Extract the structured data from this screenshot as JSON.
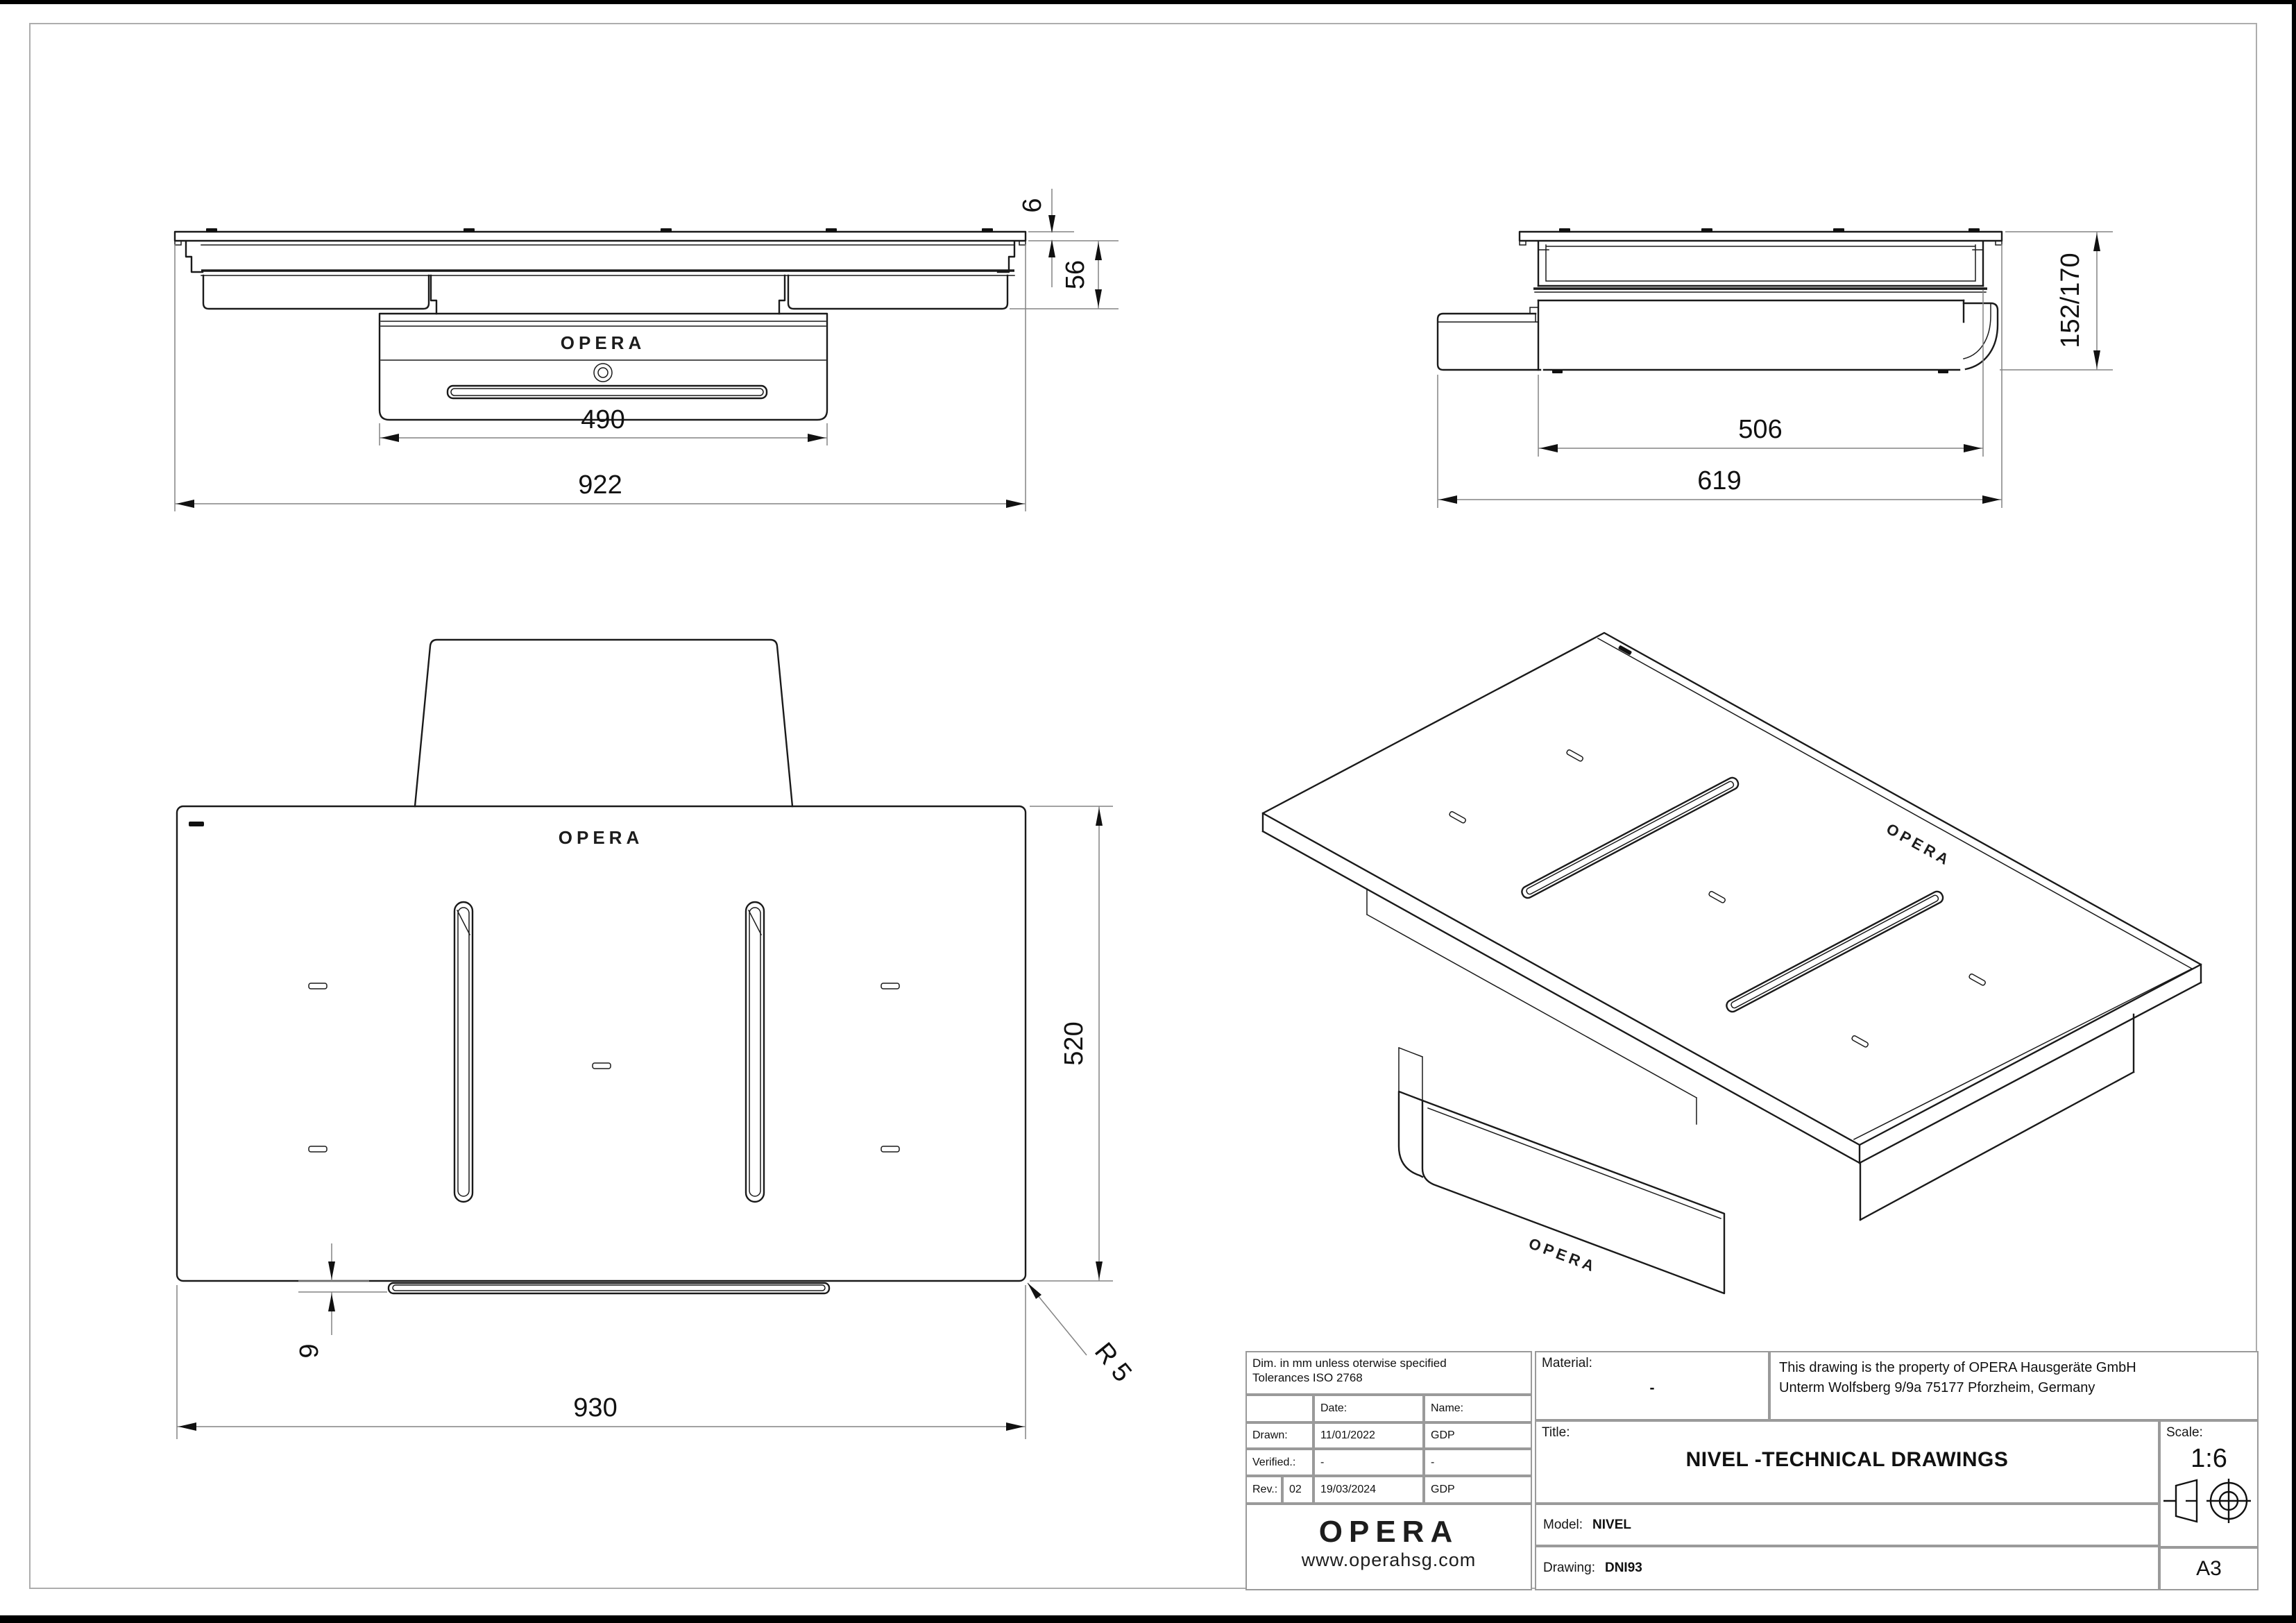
{
  "brand": {
    "name": "OPERA",
    "website": "www.operahsg.com"
  },
  "views": {
    "front": {
      "dims": {
        "drawer_width": "490",
        "overall_width": "922",
        "glass_thickness": "6",
        "body_height": "56"
      },
      "logo": "OPERA"
    },
    "side": {
      "dims": {
        "body_width": "506",
        "overall_depth": "619",
        "height_range": "152/170"
      }
    },
    "top": {
      "dims": {
        "overall_width": "930",
        "overall_depth": "520",
        "trim_height": "9",
        "corner_radius": "R 5"
      },
      "logo": "OPERA"
    },
    "iso": {
      "logo_top": "OPERA",
      "logo_front": "OPERA"
    }
  },
  "title_block": {
    "note_line1": "Dim. in mm unless oterwise specified",
    "note_line2": "Tolerances ISO 2768",
    "date_label": "Date:",
    "name_label": "Name:",
    "drawn_label": "Drawn:",
    "drawn_date": "11/01/2022",
    "drawn_name": "GDP",
    "verified_label": "Verified.:",
    "verified_date": "-",
    "verified_name": "-",
    "rev_label": "Rev.:",
    "rev_number": "02",
    "rev_date": "19/03/2024",
    "rev_name": "GDP",
    "material_label": "Material:",
    "material_value": "-",
    "property_line1": "This drawing is the property of OPERA Hausgeräte GmbH",
    "property_line2": "Unterm Wolfsberg 9/9a 75177 Pforzheim, Germany",
    "title_label": "Title:",
    "title_value": "NIVEL -TECHNICAL DRAWINGS",
    "model_label": "Model:",
    "model_value": "NIVEL",
    "drawing_label": "Drawing:",
    "drawing_value": "DNI93",
    "scale_label": "Scale:",
    "scale_value": "1:6",
    "paper_size": "A3"
  },
  "colors": {
    "line": "#1a1a1a",
    "dim_line": "#848484",
    "border": "#9a9a9a",
    "accent": "#000000"
  }
}
